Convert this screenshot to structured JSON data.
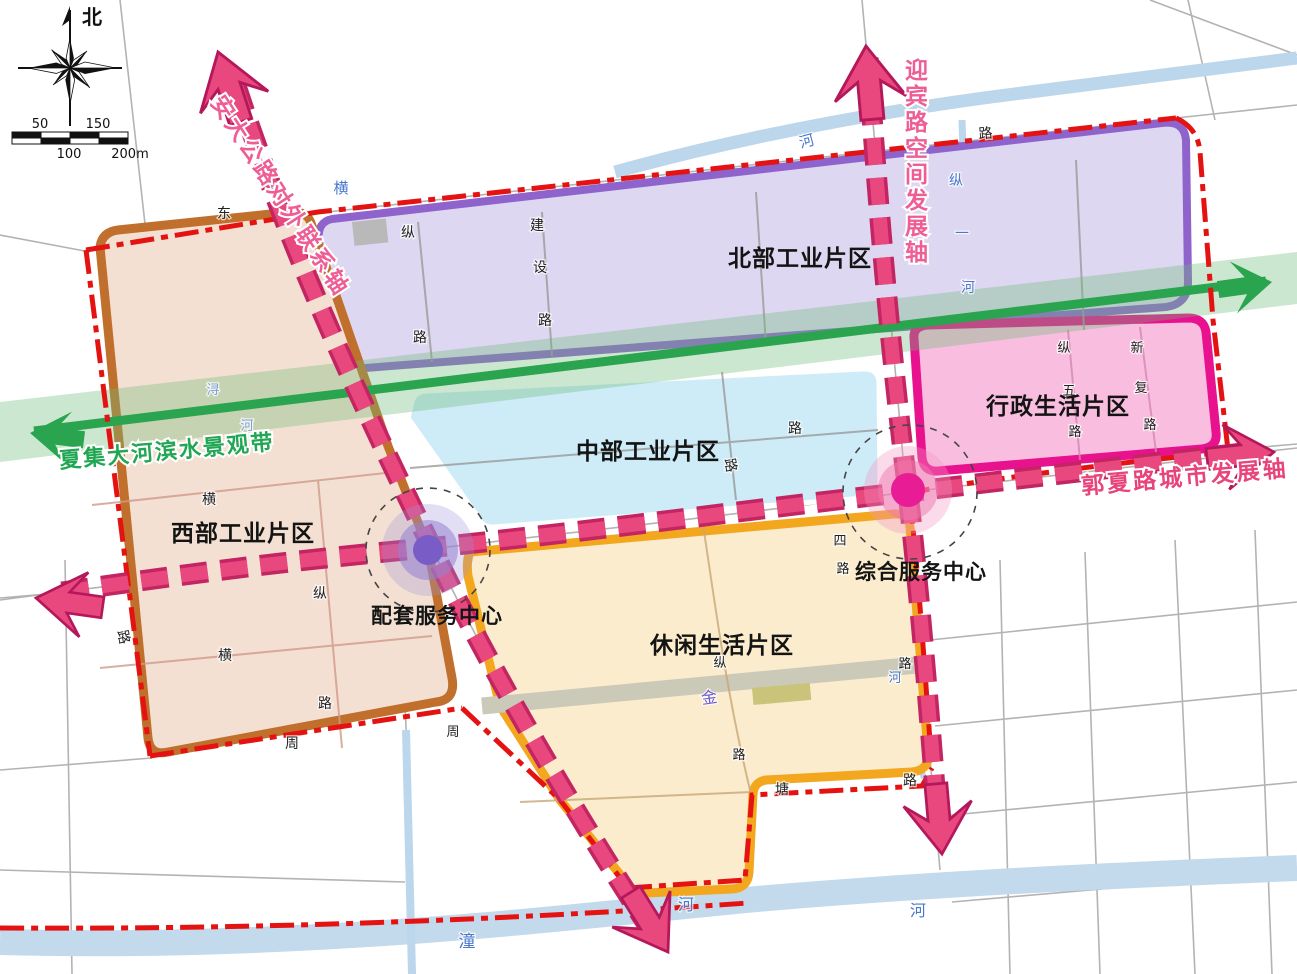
{
  "compass": {
    "north_label": "北"
  },
  "scale_bar": {
    "top_labels": [
      "50",
      "150"
    ],
    "bottom_labels": [
      "100",
      "200m"
    ]
  },
  "zones": {
    "north": {
      "label": "北部工业片区",
      "fill": "#ded7f1",
      "border": "#8f63cc"
    },
    "west": {
      "label": "西部工业片区",
      "fill": "#f4e0d2",
      "border": "#c0702c"
    },
    "central": {
      "label": "中部工业片区",
      "fill": "#cdecf8",
      "border": "#ffffff"
    },
    "admin": {
      "label": "行政生活片区",
      "fill": "#f9bedf",
      "border": "#e8118e"
    },
    "leisure": {
      "label": "休闲生活片区",
      "fill": "#fbeccd",
      "border": "#f2a71f"
    }
  },
  "centers": {
    "support": {
      "label": "配套服务中心",
      "inner_color": "#7a5cc6"
    },
    "comprehensive": {
      "label": "综合服务中心",
      "inner_color": "#e81c94"
    }
  },
  "axes": {
    "anda": {
      "label": "安大公路对外联系轴",
      "color": "#ee5e95"
    },
    "yingbin": {
      "label": "迎宾路空间发展轴",
      "color": "#ee5e95"
    },
    "guoxia": {
      "label": "郭夏路城市发展轴",
      "color": "#e8447c"
    },
    "waterfront": {
      "label": "夏集大河滨水景观带",
      "color": "#21a653"
    }
  },
  "colors": {
    "axis_pink": "#e8487e",
    "axis_dark": "#c22562",
    "boundary_red": "#e51212",
    "belt_green": "#2aa44e",
    "belt_fill": "rgba(110,185,120,0.35)",
    "river_blue": "#bcd6ec",
    "label_blue": "#4a78cc",
    "context_road": "#b3b3b3"
  },
  "road_labels": [
    {
      "t": "河",
      "x": 808,
      "y": 146,
      "c": "#4a78cc",
      "s": 15,
      "r": -15
    },
    {
      "t": "横",
      "x": 341,
      "y": 193,
      "c": "#4a78cc",
      "s": 15,
      "r": 0
    },
    {
      "t": "纵",
      "x": 956,
      "y": 185,
      "c": "#4a78cc",
      "s": 14,
      "r": 0
    },
    {
      "t": "一",
      "x": 962,
      "y": 238,
      "c": "#4a78cc",
      "s": 14,
      "r": 0
    },
    {
      "t": "河",
      "x": 968,
      "y": 292,
      "c": "#4a78cc",
      "s": 14,
      "r": 0
    },
    {
      "t": "浔",
      "x": 213,
      "y": 394,
      "c": "#7b9fd4",
      "s": 13,
      "r": 0
    },
    {
      "t": "河",
      "x": 247,
      "y": 430,
      "c": "#7b9fd4",
      "s": 13,
      "r": 0
    },
    {
      "t": "潼",
      "x": 467,
      "y": 947,
      "c": "#4a78cc",
      "s": 17,
      "r": 0
    },
    {
      "t": "河",
      "x": 686,
      "y": 910,
      "c": "#4a78cc",
      "s": 16,
      "r": 0
    },
    {
      "t": "河",
      "x": 918,
      "y": 916,
      "c": "#4a78cc",
      "s": 16,
      "r": 0
    },
    {
      "t": "河",
      "x": 895,
      "y": 682,
      "c": "#4a78cc",
      "s": 13,
      "r": 0
    },
    {
      "t": "金",
      "x": 710,
      "y": 703,
      "c": "#6a5acd",
      "s": 16,
      "r": -8
    },
    {
      "t": "东",
      "x": 224,
      "y": 218,
      "c": "#222222",
      "s": 14,
      "r": 0
    },
    {
      "t": "路",
      "x": 986,
      "y": 138,
      "c": "#222222",
      "s": 14,
      "r": -5
    },
    {
      "t": "纵",
      "x": 408,
      "y": 237,
      "c": "#222222",
      "s": 14,
      "r": 0
    },
    {
      "t": "路",
      "x": 420,
      "y": 342,
      "c": "#222222",
      "s": 14,
      "r": 0
    },
    {
      "t": "建",
      "x": 537,
      "y": 230,
      "c": "#222222",
      "s": 14,
      "r": 0
    },
    {
      "t": "设",
      "x": 540,
      "y": 272,
      "c": "#222222",
      "s": 14,
      "r": 0
    },
    {
      "t": "路",
      "x": 545,
      "y": 325,
      "c": "#222222",
      "s": 14,
      "r": 0
    },
    {
      "t": "横",
      "x": 209,
      "y": 504,
      "c": "#222222",
      "s": 14,
      "r": 0
    },
    {
      "t": "横",
      "x": 225,
      "y": 660,
      "c": "#222222",
      "s": 14,
      "r": 0
    },
    {
      "t": "纵",
      "x": 320,
      "y": 598,
      "c": "#222222",
      "s": 14,
      "r": 0
    },
    {
      "t": "路",
      "x": 325,
      "y": 708,
      "c": "#222222",
      "s": 14,
      "r": 0
    },
    {
      "t": "周",
      "x": 292,
      "y": 748,
      "c": "#222222",
      "s": 14,
      "r": 0
    },
    {
      "t": "路",
      "x": 119,
      "y": 638,
      "c": "#222222",
      "s": 14,
      "r": 78
    },
    {
      "t": "路",
      "x": 795,
      "y": 433,
      "c": "#222222",
      "s": 14,
      "r": 0
    },
    {
      "t": "路",
      "x": 726,
      "y": 466,
      "c": "#222222",
      "s": 14,
      "r": 80
    },
    {
      "t": "纵",
      "x": 1064,
      "y": 352,
      "c": "#222222",
      "s": 13,
      "r": 0
    },
    {
      "t": "五",
      "x": 1069,
      "y": 395,
      "c": "#222222",
      "s": 13,
      "r": 0
    },
    {
      "t": "路",
      "x": 1075,
      "y": 436,
      "c": "#222222",
      "s": 13,
      "r": 0
    },
    {
      "t": "新",
      "x": 1137,
      "y": 352,
      "c": "#222222",
      "s": 13,
      "r": 0
    },
    {
      "t": "复",
      "x": 1141,
      "y": 392,
      "c": "#222222",
      "s": 13,
      "r": 0
    },
    {
      "t": "路",
      "x": 1150,
      "y": 429,
      "c": "#222222",
      "s": 13,
      "r": 0
    },
    {
      "t": "四",
      "x": 840,
      "y": 545,
      "c": "#222222",
      "s": 13,
      "r": 0
    },
    {
      "t": "路",
      "x": 843,
      "y": 573,
      "c": "#222222",
      "s": 13,
      "r": 0
    },
    {
      "t": "纵",
      "x": 720,
      "y": 667,
      "c": "#222222",
      "s": 13,
      "r": 0
    },
    {
      "t": "路",
      "x": 739,
      "y": 759,
      "c": "#222222",
      "s": 13,
      "r": 0
    },
    {
      "t": "塘",
      "x": 782,
      "y": 794,
      "c": "#222222",
      "s": 14,
      "r": 0
    },
    {
      "t": "路",
      "x": 910,
      "y": 785,
      "c": "#222222",
      "s": 14,
      "r": 0
    },
    {
      "t": "路",
      "x": 905,
      "y": 668,
      "c": "#222222",
      "s": 13,
      "r": 0
    },
    {
      "t": "周",
      "x": 453,
      "y": 736,
      "c": "#222222",
      "s": 13,
      "r": 0
    }
  ]
}
